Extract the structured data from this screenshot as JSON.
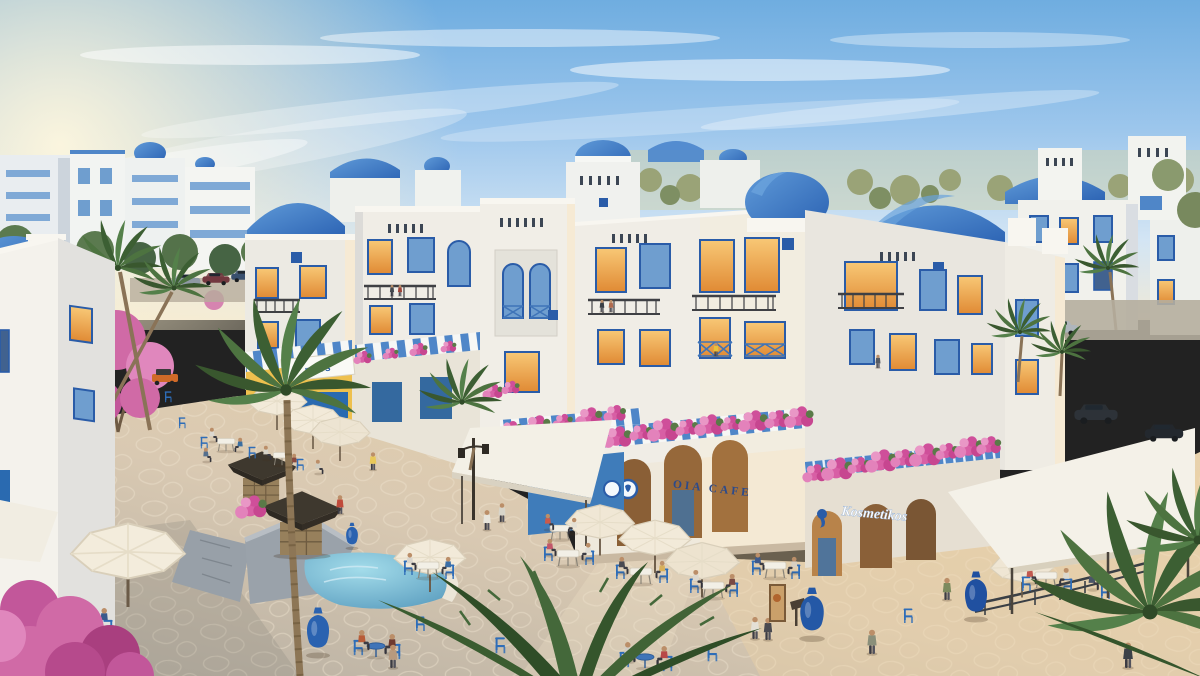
{
  "scene": {
    "description": "Sunset architectural rendering of a Mediterranean (Santorini-style) residential compound: white buildings with blue domes and barrel roofs, glowing windows, a stone-paved retail plaza with cafe umbrellas, blue chairs, palm trees, bougainvillea, kiosks, a fountain and strolling people",
    "signs": {
      "cafe": "OIA CAFE",
      "cosmetics_shop": "Kosmetikos",
      "left_shop_partial": "ness"
    },
    "palette": {
      "sky_top": "#6fade0",
      "sun_glow": "#fdf3d6",
      "dome_blue": "#3a77c6",
      "wall_white": "#f0ede6",
      "wall_shade": "#dcdbd8",
      "window_glow": "#f0a64e",
      "frame_blue": "#2a5ca8",
      "bougainvillea_pink": "#d85fa5",
      "palm_green": "#4d7340",
      "plaza_stone": "#d8c8b2",
      "chair_blue": "#2e6db8",
      "umbrella_cream": "#f2ead9",
      "awning_yellow": "#eec04e",
      "canopy_white": "#f3f0e7",
      "water_blue": "#63aecd",
      "kiosk_roof": "#3e382e"
    }
  }
}
